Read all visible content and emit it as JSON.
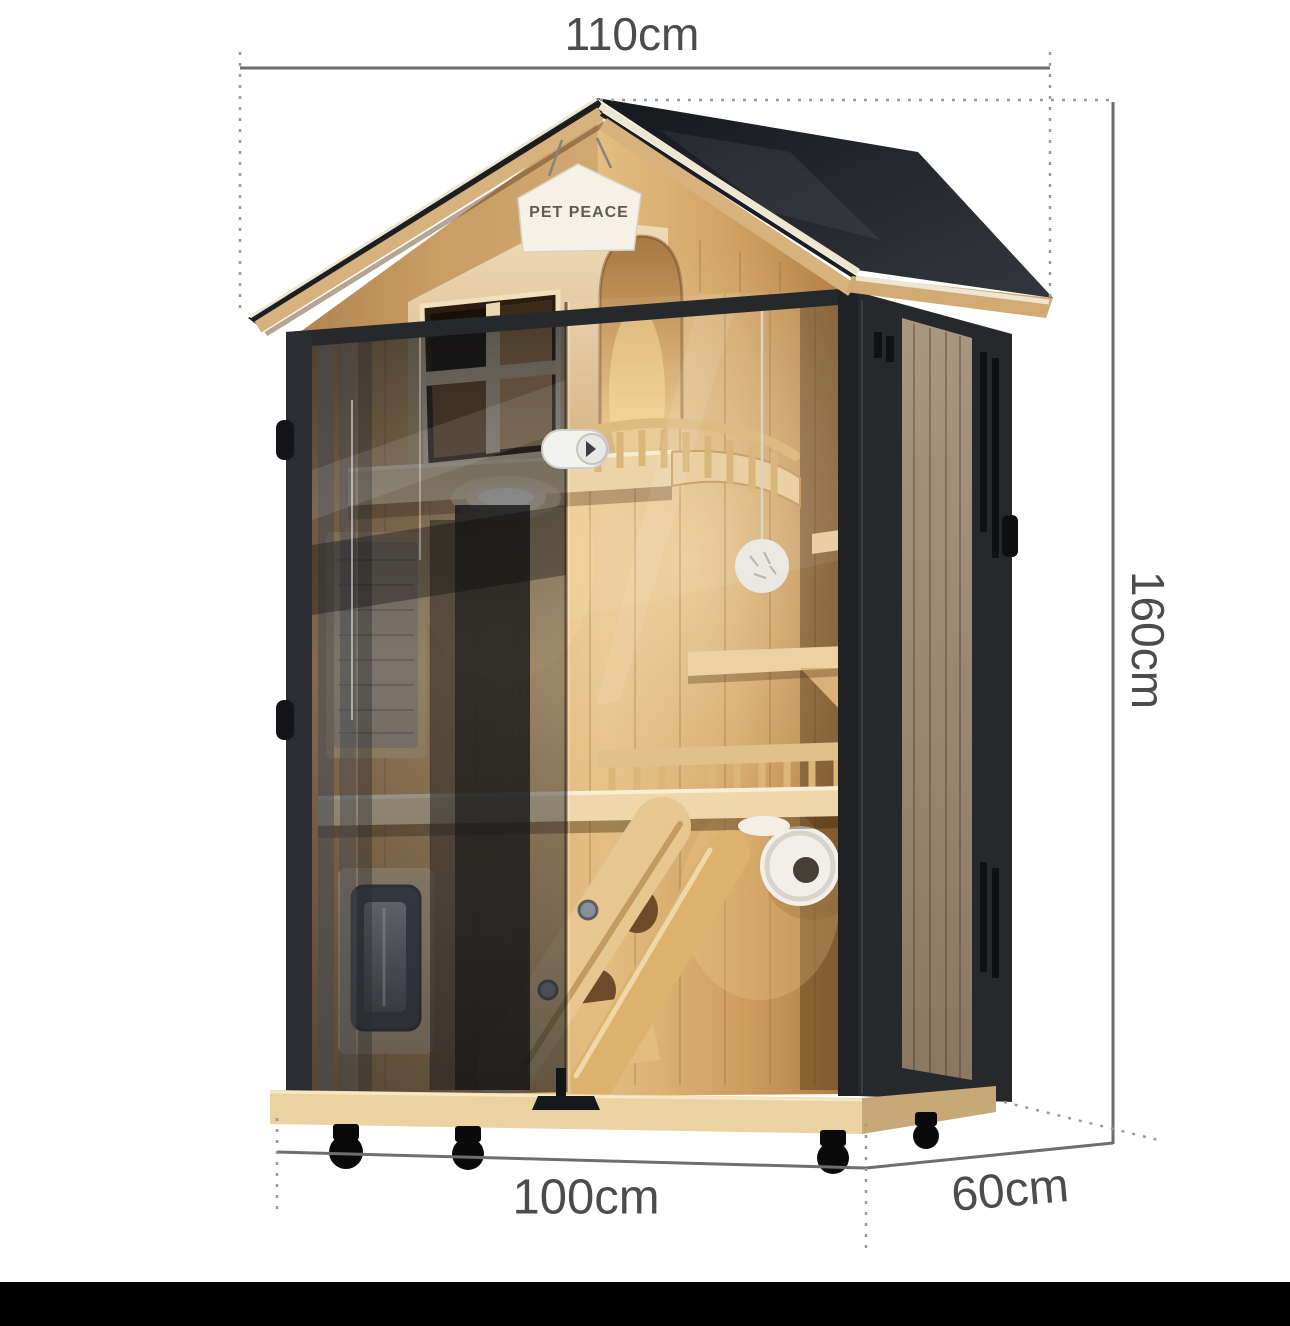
{
  "image": {
    "subject": "wooden pet house with black frame, glass doors and dimension annotations",
    "background_color": "#ffffff",
    "bottom_bar_color": "#000000"
  },
  "sign": {
    "text": "PET PEACE"
  },
  "dimensions": {
    "top_width_label": "110cm",
    "height_label": "160cm",
    "bottom_width_label": "100cm",
    "depth_label": "60cm"
  },
  "colors": {
    "dimension_line": "#6e6e6e",
    "extension_line": "#9a9a9a",
    "label_text": "#4c4c4c",
    "roof_black": "#1c1e22",
    "frame_black": "#26282c",
    "wood_light": "#e3bd82",
    "wood_mid": "#d3a368",
    "wood_dark": "#a8753d",
    "side_slat_wood": "#9c8a72",
    "base_wood": "#ead2a2",
    "sign_background": "#f6f1e6"
  }
}
